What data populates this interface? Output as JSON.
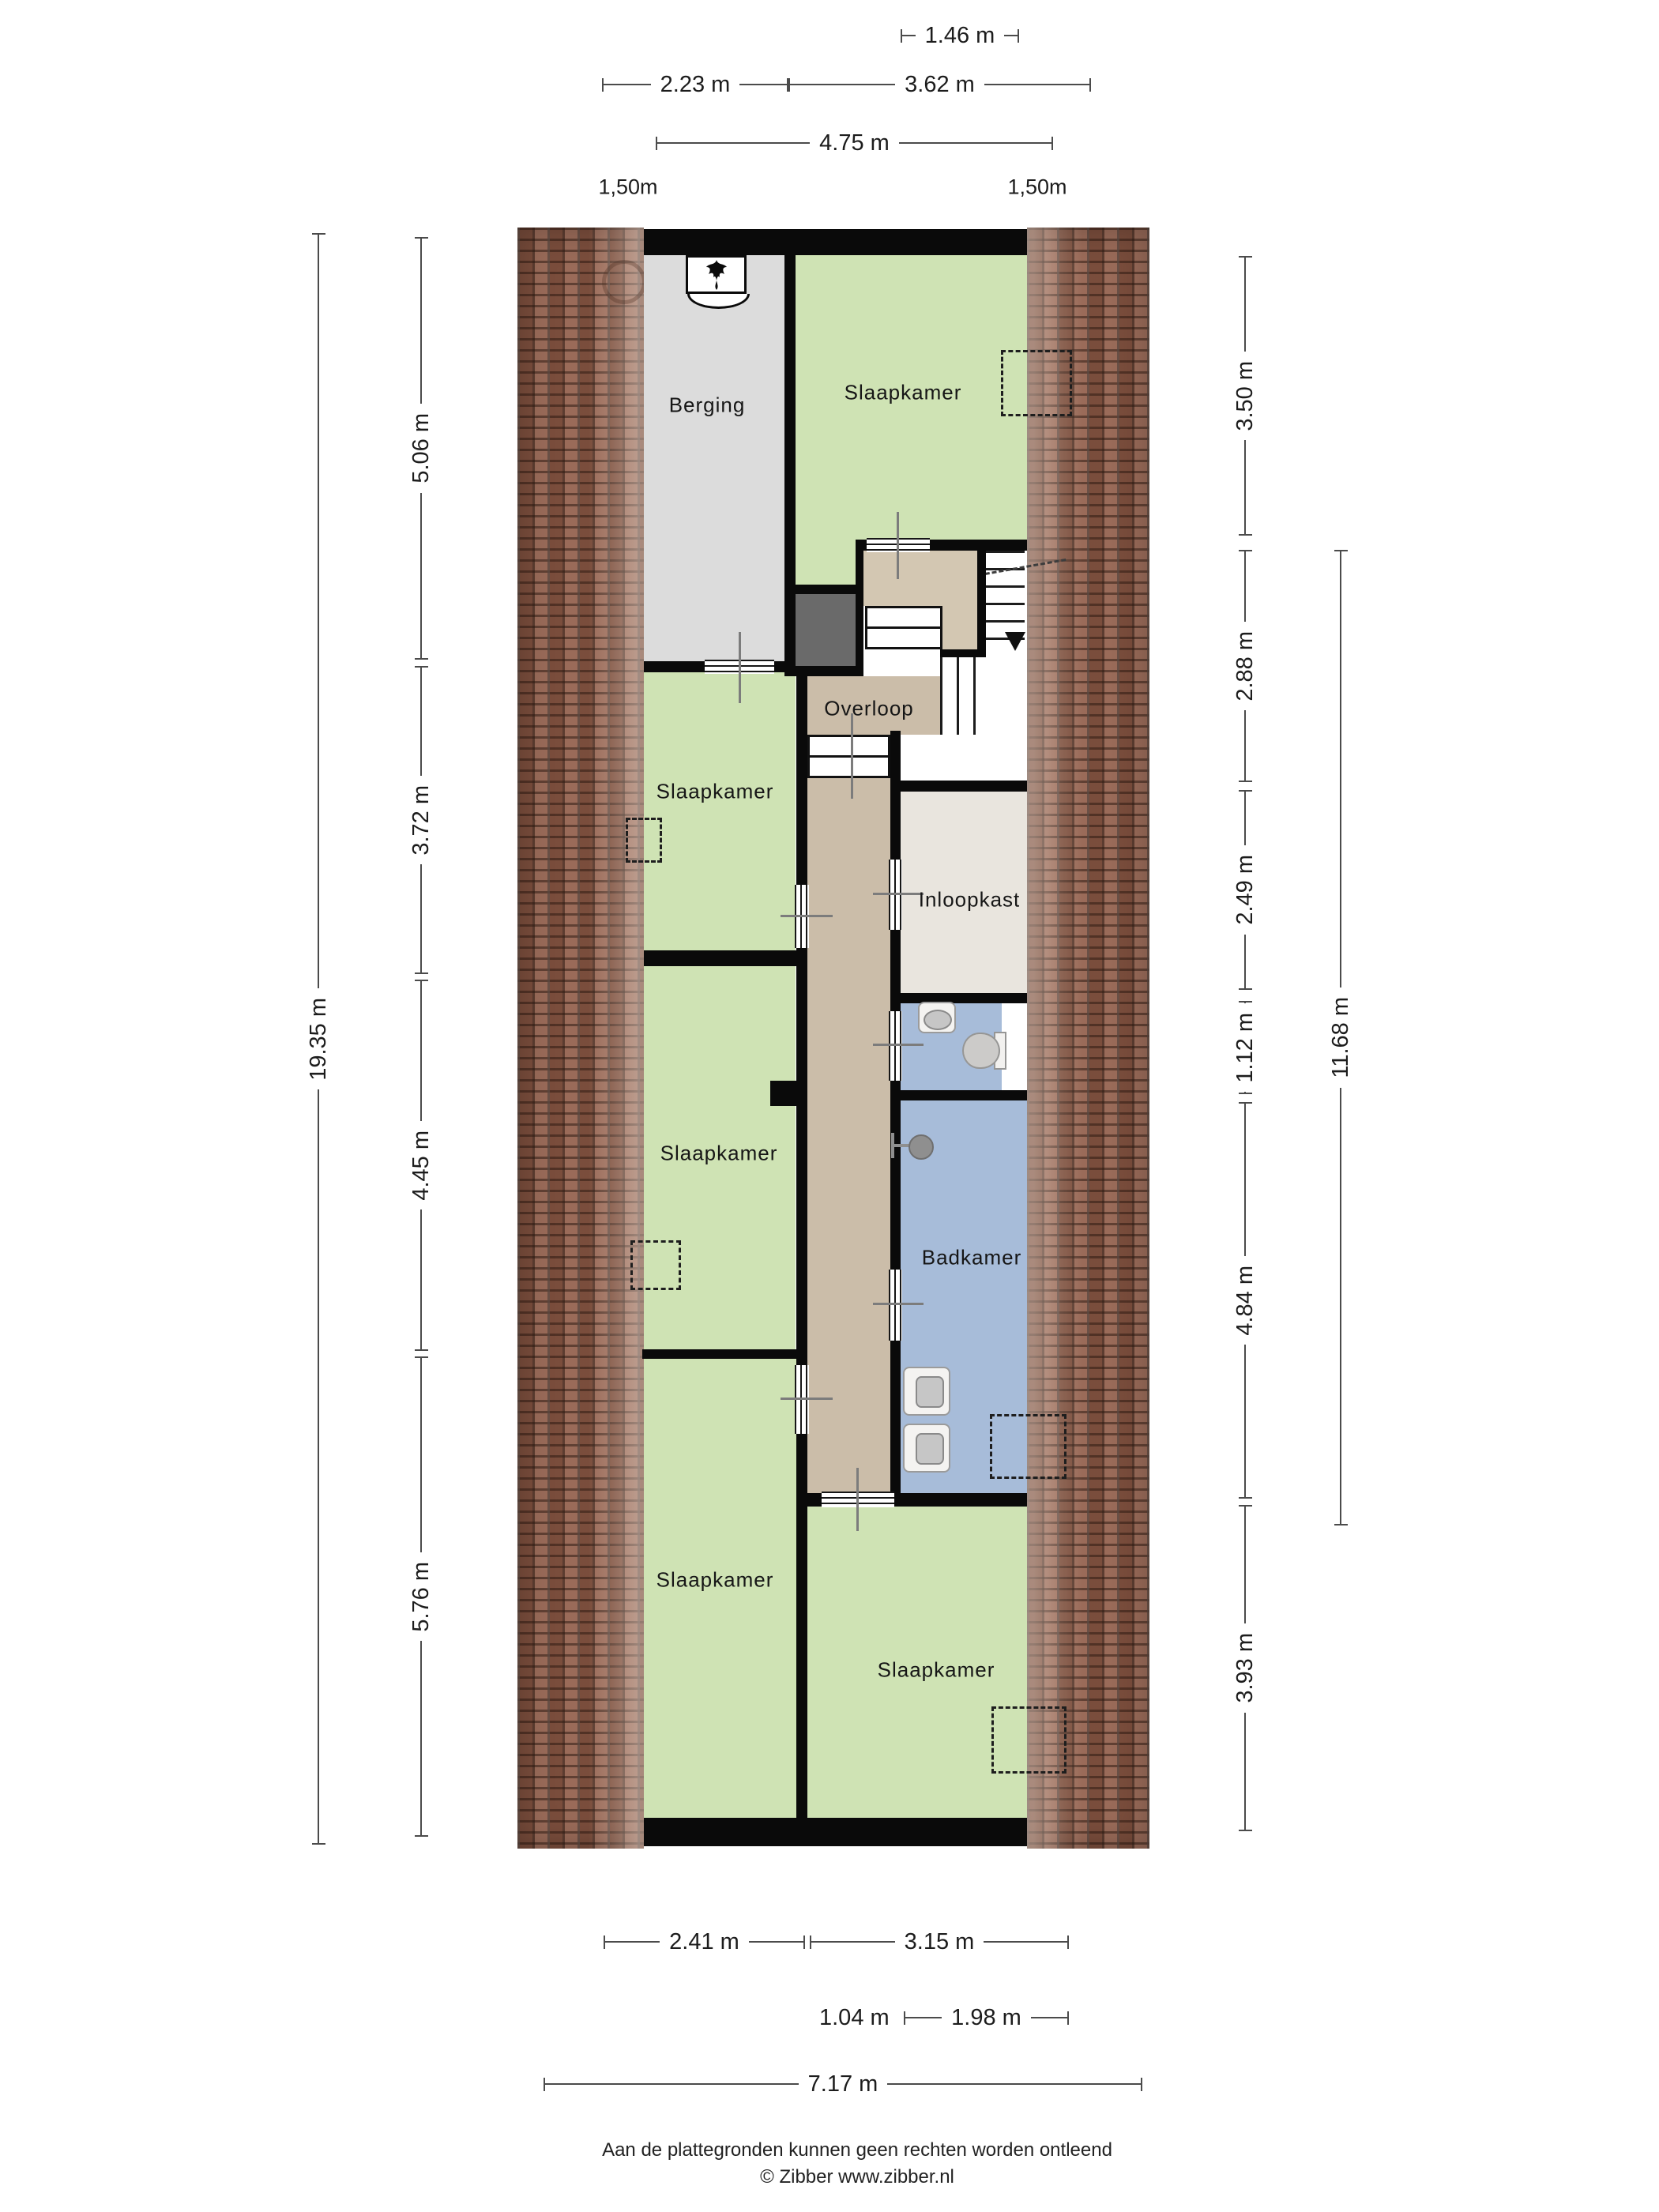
{
  "rooms": {
    "berging": "Berging",
    "slaapkamer_top": "Slaapkamer",
    "slaapkamer_left_upper": "Slaapkamer",
    "overloop": "Overloop",
    "inloopkast": "Inloopkast",
    "slaapkamer_left_middle": "Slaapkamer",
    "badkamer": "Badkamer",
    "slaapkamer_left_lower": "Slaapkamer",
    "slaapkamer_bottom_right": "Slaapkamer"
  },
  "dimensions": {
    "top_row1": "1.46 m",
    "top_row2_left": "2.23 m",
    "top_row2_right": "3.62 m",
    "top_row3": "4.75 m",
    "roof_width_left": "1,50m",
    "roof_width_right": "1,50m",
    "left_outer": "19.35 m",
    "left_seg1": "5.06 m",
    "left_seg2": "3.72 m",
    "left_seg3": "4.45 m",
    "left_seg4": "5.76 m",
    "right_seg1": "3.50 m",
    "right_seg2": "2.88 m",
    "right_seg3": "2.49 m",
    "right_seg4": "1.12 m",
    "right_seg5": "4.84 m",
    "right_seg6": "3.93 m",
    "right_outer": "11.68 m",
    "bottom_row1_left": "2.41 m",
    "bottom_row1_right": "3.15 m",
    "bottom_row2_left": "1.04 m",
    "bottom_row2_right": "1.98 m",
    "bottom_row3": "7.17 m"
  },
  "footer": {
    "disclaimer": "Aan de plattegronden kunnen geen rechten worden ontleend",
    "copyright": "© Zibber www.zibber.nl"
  },
  "colors": {
    "wall": "#0a0a0a",
    "room_green": "#cfe3b4",
    "room_gray": "#dcdcdc",
    "hall_tan": "#cbbda9",
    "closet_offwhite": "#e9e5de",
    "bath_blue": "#a7bcd9",
    "void_gray": "#6a6a6a",
    "roof_brown": "#8e5a46",
    "dim_line": "#4b4b4b"
  }
}
